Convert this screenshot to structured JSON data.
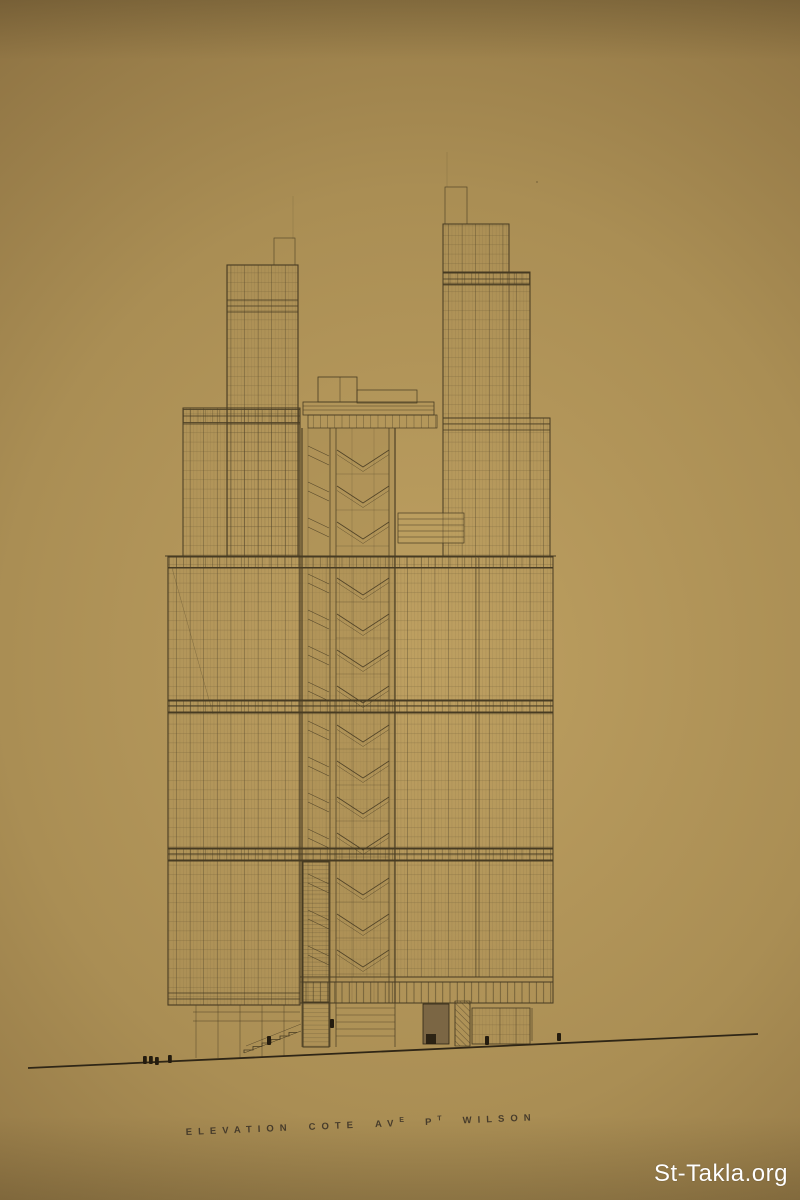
{
  "caption": {
    "full_text": "ELEVATION COTE AVE PT WILSON",
    "words": [
      {
        "text": "ELEVATION",
        "sup": ""
      },
      {
        "text": "COTE",
        "sup": ""
      },
      {
        "text": "AV",
        "sup": "E"
      },
      {
        "text": "P",
        "sup": "T"
      },
      {
        "text": "WILSON",
        "sup": ""
      }
    ]
  },
  "watermark": {
    "text": "St-Takla.org"
  },
  "colors": {
    "paper_center": "#bea061",
    "paper_mid": "#aa8e54",
    "paper_edge": "#8b7041",
    "paper_corner": "#7a6236",
    "ink": "#473b22",
    "ink_dark": "#2f2616",
    "shade": "#7b6644",
    "figure_fill": "#241c0f",
    "caption_ink": "#3a3126",
    "watermark_color": "#ffffff"
  }
}
